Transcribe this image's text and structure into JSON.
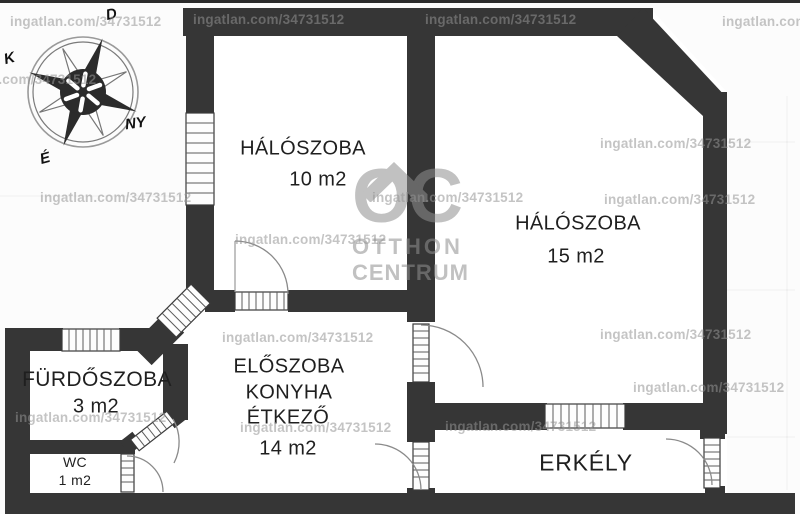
{
  "watermark": {
    "text": "ingatlan.com/34731512"
  },
  "logo": {
    "initials": "OC",
    "word1": "OTTHON",
    "word2": "CENTRUM"
  },
  "compass": {
    "south": "D",
    "east": "K",
    "west": "NY",
    "north": "É"
  },
  "rooms": {
    "bedroom_small": {
      "name": "HÁLÓSZOBA",
      "area": "10 m2"
    },
    "bedroom_large": {
      "name": "HÁLÓSZOBA",
      "area": "15 m2"
    },
    "hall": {
      "name_line1": "ELŐSZOBA",
      "name_line2": "KONYHA",
      "name_line3": "ÉTKEZŐ",
      "area": "14 m2"
    },
    "bathroom": {
      "name": "FÜRDŐSZOBA",
      "area": "3 m2"
    },
    "wc": {
      "name": "WC",
      "area": "1 m2"
    },
    "balcony": {
      "name": "ERKÉLY"
    }
  },
  "colors": {
    "wall": "#363636",
    "watermark": "#949494",
    "logo": "#8f8f8f"
  }
}
